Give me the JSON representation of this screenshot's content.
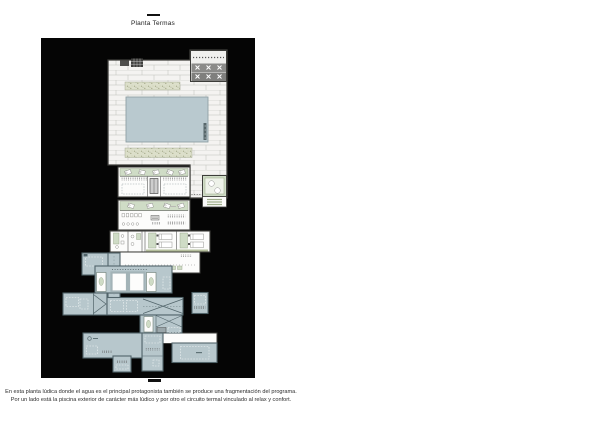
{
  "header": {
    "title": "Planta Termas"
  },
  "caption": {
    "line1": "En esta planta lúdica donde el agua es el principal protagonista también se produce una fragmentación del programa.",
    "line2": "Por un lado está la piscina exterior de carácter más lúdico y por otro el circuito termal vinculado al relax y confort."
  },
  "colors": {
    "page_background": "#ffffff",
    "panel_background": "#050505",
    "deck_fill": "#f4f3f1",
    "deck_line": "#bfbfba",
    "outline_dark": "#3d3d3a",
    "pool_fill": "#b9c9cf",
    "pool_outline": "#8fa0a5",
    "vegetation_fill": "#dcdfca",
    "vegetation_dot": "#a0a584",
    "green_room_fill": "#cfdcc6",
    "thermal_room_fill": "#b7c7cc",
    "thermal_room_outline": "#51646a",
    "lounge_band_fill": "#8b8b89",
    "white_pool_border": "#a3b3b7"
  }
}
